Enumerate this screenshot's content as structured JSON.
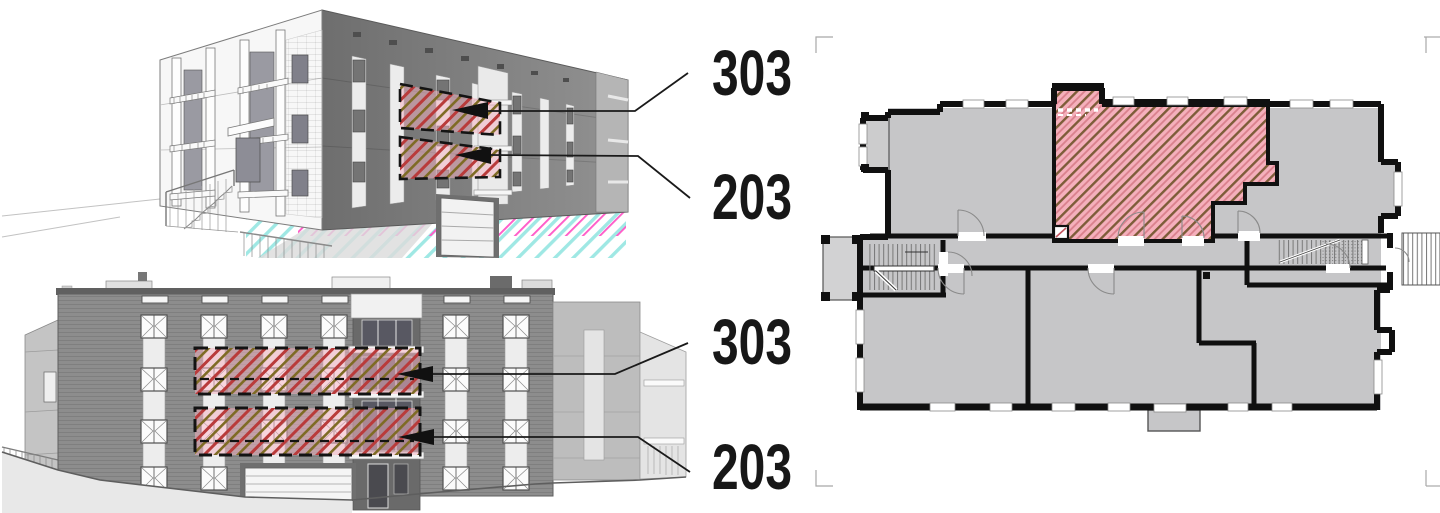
{
  "labels": {
    "perspective_upper_unit": "303",
    "perspective_lower_unit": "203",
    "elevation_upper_unit": "303",
    "elevation_lower_unit": "203"
  },
  "colors": {
    "label_text": "#171717",
    "leader_line": "#1a1a1a",
    "hatch_pink": "#f5b0bc",
    "hatch_brown": "#7d5c38",
    "hatch_red": "#b93b3b",
    "hatch_olive": "#7e6b24",
    "plan_room_fill": "#c6c6c8",
    "plan_wall": "#101010",
    "facade_gray": "#8d8d8d",
    "site_cyan": "#9fe8e4",
    "site_magenta": "#ff5cc8"
  }
}
